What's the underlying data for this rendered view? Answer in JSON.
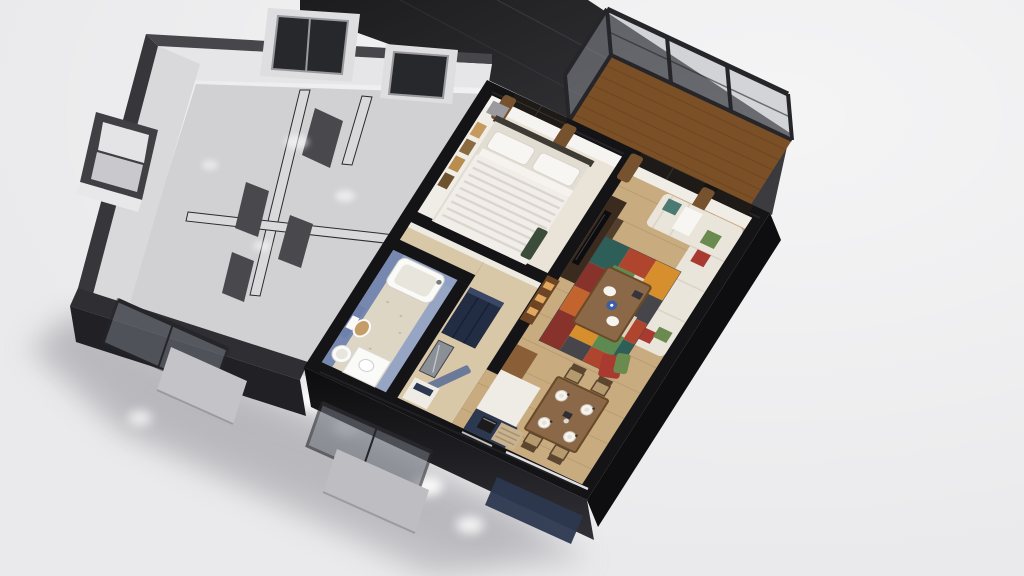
{
  "view": {
    "type": "3d-floorplan-dollhouse-render",
    "camera": "isometric-top-down",
    "background": "#eaeaec"
  },
  "palette": {
    "bg": "#eaeaec",
    "shadow": "#b7b7bc",
    "shadow_soft": "#a7a7ad",
    "light_patch": "#ffffff",
    "roof_dark": "#202023",
    "roof_mid": "#3b3b3f",
    "roof_seam": "#4a4a4f",
    "gray_cap": "#46464b",
    "gray_cap_side": "#36363b",
    "gray_face": "#d9d9db",
    "gray_face_top": "#e6e6e8",
    "gray_front_cap": "#2e2e33",
    "gray_front_face": "#202025",
    "gray_floor": "#d1d1d4",
    "gray_partition": "#d9d9dc",
    "gray_door": "#48484d",
    "gray_window": "#26282b",
    "gray_window_frame": "#9a9a9e",
    "gray_window_back": "#dedee0",
    "gray_pane_light": "#e4e4e7",
    "gray_pane_dim": "#c9c9cd",
    "gray_sill": "#e8e8eb",
    "black_wall": "#141417",
    "black_wall_sheen": "#35353c",
    "white_wall": "#f6f4f0",
    "white_wall_dim": "#f0ede7",
    "wood_floor": "#c9ab80",
    "wood_plank": "#a98c63",
    "hall_floor": "#d8c8a8",
    "bedroom_floor": "#eae3d8",
    "bath_floor": "#ded6c4",
    "bath_speckle": "#b8ad94",
    "bath_wall": "#8fa0c4",
    "bath_wall_dark": "#7688b0",
    "bath_panel": "#6e81ab",
    "fixture_white": "#fafaf8",
    "fixture_inner": "#e8e5dc",
    "toilet_seat": "#c49e66",
    "deck_wood": "#7c5026",
    "deck_line": "#5e3c1c",
    "rail_frame": "#26262a",
    "rail_glass": "#a9adb4",
    "low_glass": "#787c86",
    "low_glass_b": "#6e727c",
    "concrete": "#c4c4c8",
    "concrete_b": "#bebec2",
    "navy": "#2c3850",
    "navy_dark": "#222c42",
    "slate_door": "#6b7a99",
    "mirror": "#8b8f96",
    "shelf_wood": "#6e4524",
    "amber": "#e2a85f",
    "tv_unit": "#3a2b1e",
    "tv_shelf": "#53402c",
    "tv_screen": "#0d0d0f",
    "sofa": "#eae5da",
    "sofa_shade": "#d8d1c3",
    "pillow_white": "#f7f6f2",
    "pillow_green": "#6a8a50",
    "pillow_red": "#a83a30",
    "pillow_teal": "#4a7a72",
    "table_wood": "#8a6848",
    "table_edge": "#6b4a28",
    "chair_frame": "#5d4630",
    "chair_seat": "#b59a6e",
    "plate": "#f5f4f0",
    "plate_inner": "#e8e2d4",
    "blue_bowl": "#3a5fa8",
    "rug_red": "#b0452e",
    "rug_orange": "#d78f2e",
    "rug_green": "#5c8a50",
    "rug_teal": "#2e5e58",
    "rug_dark_red": "#87322a",
    "rug_cream": "#ddd3c2",
    "rug_dark": "#46464a",
    "rug_rust": "#c2642e",
    "curtain": "#76522e",
    "window_dark": "#1d1a17",
    "headboard": "#3e3a34",
    "bed_base": "#e2ddd3",
    "bed_fold": "#f6f3ee",
    "duvet": "#f1eee9",
    "duvet_stripe": "#d8d3cc",
    "bench_green": "#3c4c3a",
    "nightstand": "#9b9b9f",
    "art_gold": "#c59a5d",
    "art_brown": "#8a6a3f",
    "art_tan": "#b98d4f",
    "art_dark": "#6e5230",
    "mat": "#c7b391",
    "mat_stripe": "#a8906a",
    "counter_white": "#efece6",
    "kitchen_wood": "#8a5f38",
    "oven_dark": "#1b1b1e",
    "brown_wall": "#7a4a26",
    "white_stripe": "#eaeaec",
    "dark_item": "#35353a"
  },
  "scene": {
    "description": "Isometric 3D dollhouse cutaway render of one apartment floor; left unit gray and unfurnished, right unit furnished; no text or UI chrome visible",
    "units": [
      {
        "name": "unfurnished-mirror-unit",
        "style": "gray-monochrome",
        "features": [
          "open-gray-doors",
          "interior-partitions",
          "window-on-left-wall",
          "two-windows-on-top-wall",
          "floor-light-patches"
        ]
      },
      {
        "name": "furnished-unit",
        "rooms": [
          {
            "name": "bedroom",
            "furniture": [
              "double-bed-striped-duvet",
              "two-pillows",
              "headboard",
              "green-bench",
              "nightstand",
              "four-wall-frames",
              "window-with-brown-curtains"
            ]
          },
          {
            "name": "bathroom",
            "wall_color": "#8fa0c4",
            "furniture": [
              "bathtub",
              "wall-hung-toilet-wood-seat",
              "washing-machine",
              "white-vanity"
            ]
          },
          {
            "name": "entry-hall",
            "furniture": [
              "dark-wardrobe",
              "mirror",
              "open-slate-door",
              "white-shoe-cabinet",
              "lit-shelf-unit"
            ]
          },
          {
            "name": "kitchen",
            "furniture": [
              "navy-base-cabinets",
              "white-counter",
              "tall-wood-cabinet",
              "dark-oven"
            ]
          },
          {
            "name": "living-room",
            "furniture": [
              "l-shaped-cream-sofa",
              "green-red-teal-pillows",
              "patchwork-rug",
              "wood-coffee-table-with-plates-and-blue-bowl",
              "tv-wall-unit",
              "balcony-sliding-door-brown-curtains",
              "red-green-lounge-chair"
            ]
          },
          {
            "name": "dining-area",
            "furniture": [
              "wood-dining-table",
              "four-chairs",
              "four-white-place-settings",
              "striped-floor-mat"
            ]
          }
        ]
      }
    ],
    "balcony": {
      "deck": "wood-planks",
      "railing": "glass-panels-dark-metal-frame",
      "panels": 3
    },
    "exterior": {
      "adjacent_roof_band": true,
      "brown_exterior_wall_patch": true,
      "lower_glass_balconies": 2,
      "concrete_slabs": 2,
      "glossy_black_wall_caps": true
    },
    "ground": {
      "soft_shadow_lower_left": true,
      "window_light_patches": 6
    }
  }
}
